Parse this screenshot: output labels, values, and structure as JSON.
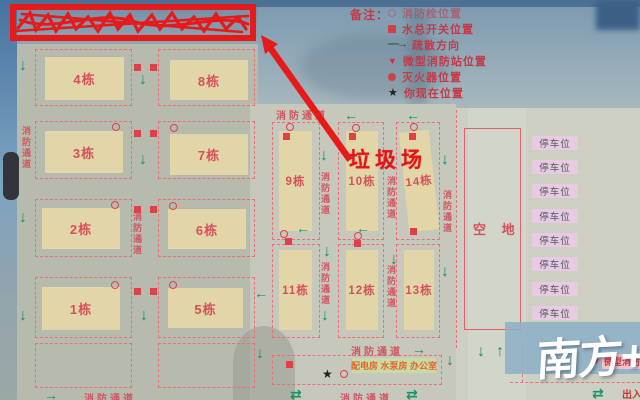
{
  "labels": {
    "fire_lane": "消防通道",
    "garbage": "垃圾场",
    "empty_lot": "空 地",
    "parking": "停车位",
    "facilities": "配电房 水泵房 办公室",
    "mini_station": "微型消防站",
    "entrance_exit": "出入",
    "watermark": "南方+"
  },
  "legend": {
    "title": "备注：",
    "items": [
      {
        "icon": "fire-hydrant",
        "label": "消防栓位置"
      },
      {
        "icon": "water-main-switch",
        "label": "水总开关位置"
      },
      {
        "icon": "evacuation-arrow",
        "label": "疏散方向"
      },
      {
        "icon": "mini-fire-station",
        "label": "微型消防站位置"
      },
      {
        "icon": "fire-extinguisher",
        "label": "灭火器位置"
      },
      {
        "icon": "you-are-here",
        "label": "你现在位置"
      }
    ]
  },
  "buildings": [
    "1栋",
    "2栋",
    "3栋",
    "4栋",
    "5栋",
    "6栋",
    "7栋",
    "8栋",
    "9栋",
    "10栋",
    "11栋",
    "12栋",
    "13栋",
    "14栋"
  ],
  "colors": {
    "annotation_red": "#e61a1a",
    "marker_red": "#e04048",
    "dashed_line": "#ee6d77",
    "lane_text": "#d05560",
    "arrow_green": "#17906b",
    "building_fill": "#e2d6a8",
    "parking_fill": "#e8cbe3",
    "facility_fill": "#c9dba4",
    "sky_blue": "#7b99b0"
  }
}
